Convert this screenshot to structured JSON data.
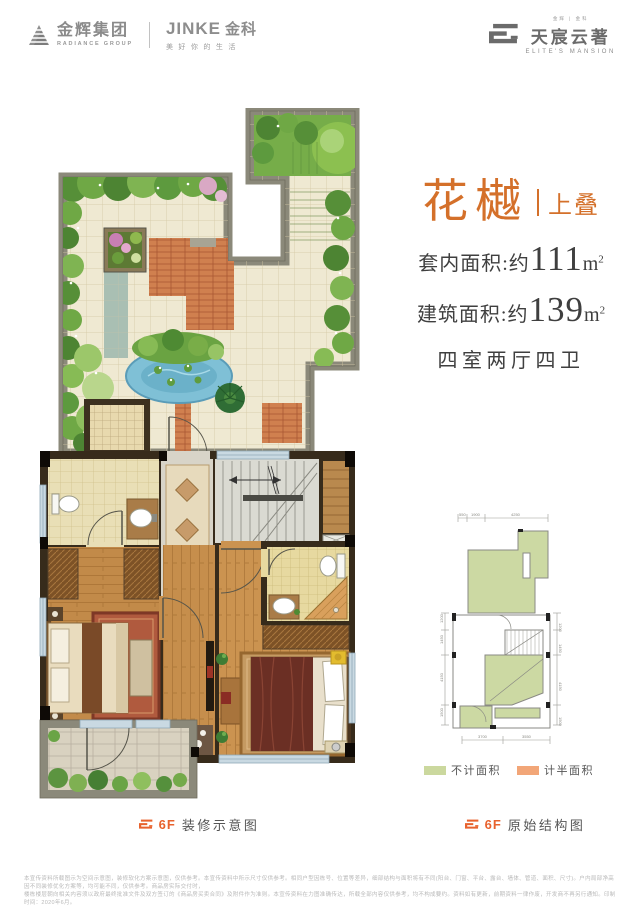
{
  "header": {
    "radiance_name": "金辉集团",
    "radiance_sub": "RADIANCE GROUP",
    "jinke_name": "JINKE",
    "jinke_cn": "金科",
    "jinke_tagline": "美好你的生活",
    "estate_top": "金辉 | 金科",
    "estate_name": "天宸云著",
    "estate_sub": "ELITE'S MANSION"
  },
  "unit": {
    "title": "花樾",
    "tag": "上叠",
    "inner_label": "套内面积:约",
    "inner_value": "111",
    "build_label": "建筑面积:约",
    "build_value": "139",
    "unit_letter": "m",
    "unit_sup": "2",
    "rooms": "四室两厅四卫"
  },
  "captions": {
    "left_floor": "6F",
    "left_label": "装修示意图",
    "right_floor": "6F",
    "right_label": "原始结构图"
  },
  "legend": {
    "no_area": "不计面积",
    "half_area": "计半面积",
    "no_area_color": "#cbd89e",
    "half_area_color": "#f2a678"
  },
  "structural": {
    "dims_top": [
      "550",
      "1900",
      "4250"
    ],
    "dims_left": [
      "1200",
      "1450",
      "4150",
      "1500"
    ],
    "dims_right": [
      "1200",
      "1450",
      "4150",
      "1500"
    ],
    "dims_bottom": [
      "3700",
      "3550"
    ]
  },
  "disclaimer": {
    "line1": "本宣传资料所载图示为空间示意图，装修软化方案示意图，仅供参考。本宣传资料中所示尺寸仅供参考。相同户型因栋号、位置等差异，细部结构与面积将有不同(阳台、门窗、平台、露台、墙体、管道、面积、尺寸)。户内局部净高因不同装修优化方案等，均可能不同，仅供参考。商品房实际交付时，",
    "line2": "楼栋楼层朝向相关内容须以政府最终批准文件及双方签订的《商品房买卖合同》及附件作为准则。本宣传资料在力图准确传达，所载全部内容仅供参考，均不构成要约。资料如有更新，前期资料一律作废，开发商不再另行通知。印制时间：2020年6月。"
  },
  "colors": {
    "accent_orange": "#d4702a",
    "caption_orange": "#e8622d",
    "garden_wall": "#8b897a",
    "house_wall": "#372b1b",
    "text_dark": "#3f3f3f"
  }
}
